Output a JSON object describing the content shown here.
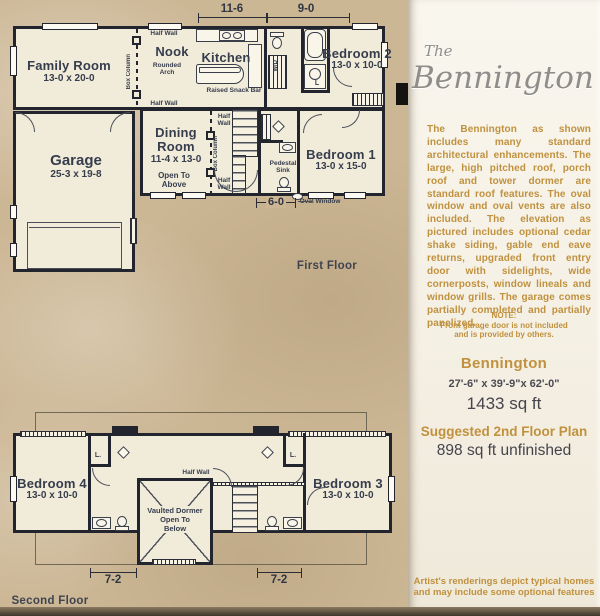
{
  "colors": {
    "background_tan": "#ccb795",
    "panel_cream": "#f5f0e4",
    "wall_ink": "#23252e",
    "plan_text": "#363d4d",
    "accent_gold": "#c0913e",
    "title_gray": "#8f8d89"
  },
  "floor1": {
    "title": "First Floor",
    "dim_top_left": "11-6",
    "dim_top_right": "9-0",
    "dim_bottom": "6-0",
    "oval_window": "Oval Window",
    "family_room": {
      "name": "Family Room",
      "size": "13-0 x 20-0"
    },
    "nook": "Nook",
    "kitchen": "Kitchen",
    "bedroom2": {
      "name": "Bedroom 2",
      "size": "13-0 x 10-0"
    },
    "bedroom1": {
      "name": "Bedroom 1",
      "size": "13-0 x 15-0"
    },
    "dining": {
      "name1": "Dining",
      "name2": "Room",
      "size": "11-4 x 13-0"
    },
    "garage": {
      "name": "Garage",
      "size": "25-3 x 19-8"
    },
    "open_above1": "Open To",
    "open_above2": "Above",
    "half_wall": "Half Wall",
    "half1": "Half",
    "half2": "Wall",
    "box_column": "Box Column",
    "rounded_arch1": "Rounded",
    "rounded_arch2": "Arch",
    "snack_bar": "Raised Snack Bar",
    "pedestal1": "Pedestal",
    "pedestal2": "Sink",
    "wd": "W/D",
    "l_closet": "L"
  },
  "floor2": {
    "title": "Second Floor",
    "bedroom4": {
      "name": "Bedroom 4",
      "size": "13-0 x 10-0"
    },
    "bedroom3": {
      "name": "Bedroom 3",
      "size": "13-0 x 10-0"
    },
    "vaulted1": "Vaulted Dormer",
    "vaulted2": "Open To",
    "vaulted3": "Below",
    "half_wall": "Half Wall",
    "l_closet": "L.",
    "dim_left": "7-2",
    "dim_right": "7-2"
  },
  "panel": {
    "brand_prefix": "The",
    "brand_name": "Bennington",
    "description": "The Bennington as shown includes many standard architectural enhancements. The large, high pitched roof, porch roof and tower dormer are standard roof features. The oval window and oval vents are also included. The elevation as pictured includes optional cedar shake siding, gable end eave returns, upgraded front entry door with sidelights, wide cornerposts, window lineals and window grills. The garage comes partially completed and partially panelized.",
    "note_label": "NOTE:",
    "note_line1": "Front garage door is not included",
    "note_line2": "and is provided by others.",
    "model_name": "Bennington",
    "dimensions": "27'-6\" x 39'-9\"x 62'-0\"",
    "area_main": "1433 sq ft",
    "suggested_title": "Suggested 2nd Floor Plan",
    "area_second": "898 sq ft unfinished",
    "disclaimer_line1": "Artist's renderings depict typical homes",
    "disclaimer_line2": "and may include some optional features"
  }
}
